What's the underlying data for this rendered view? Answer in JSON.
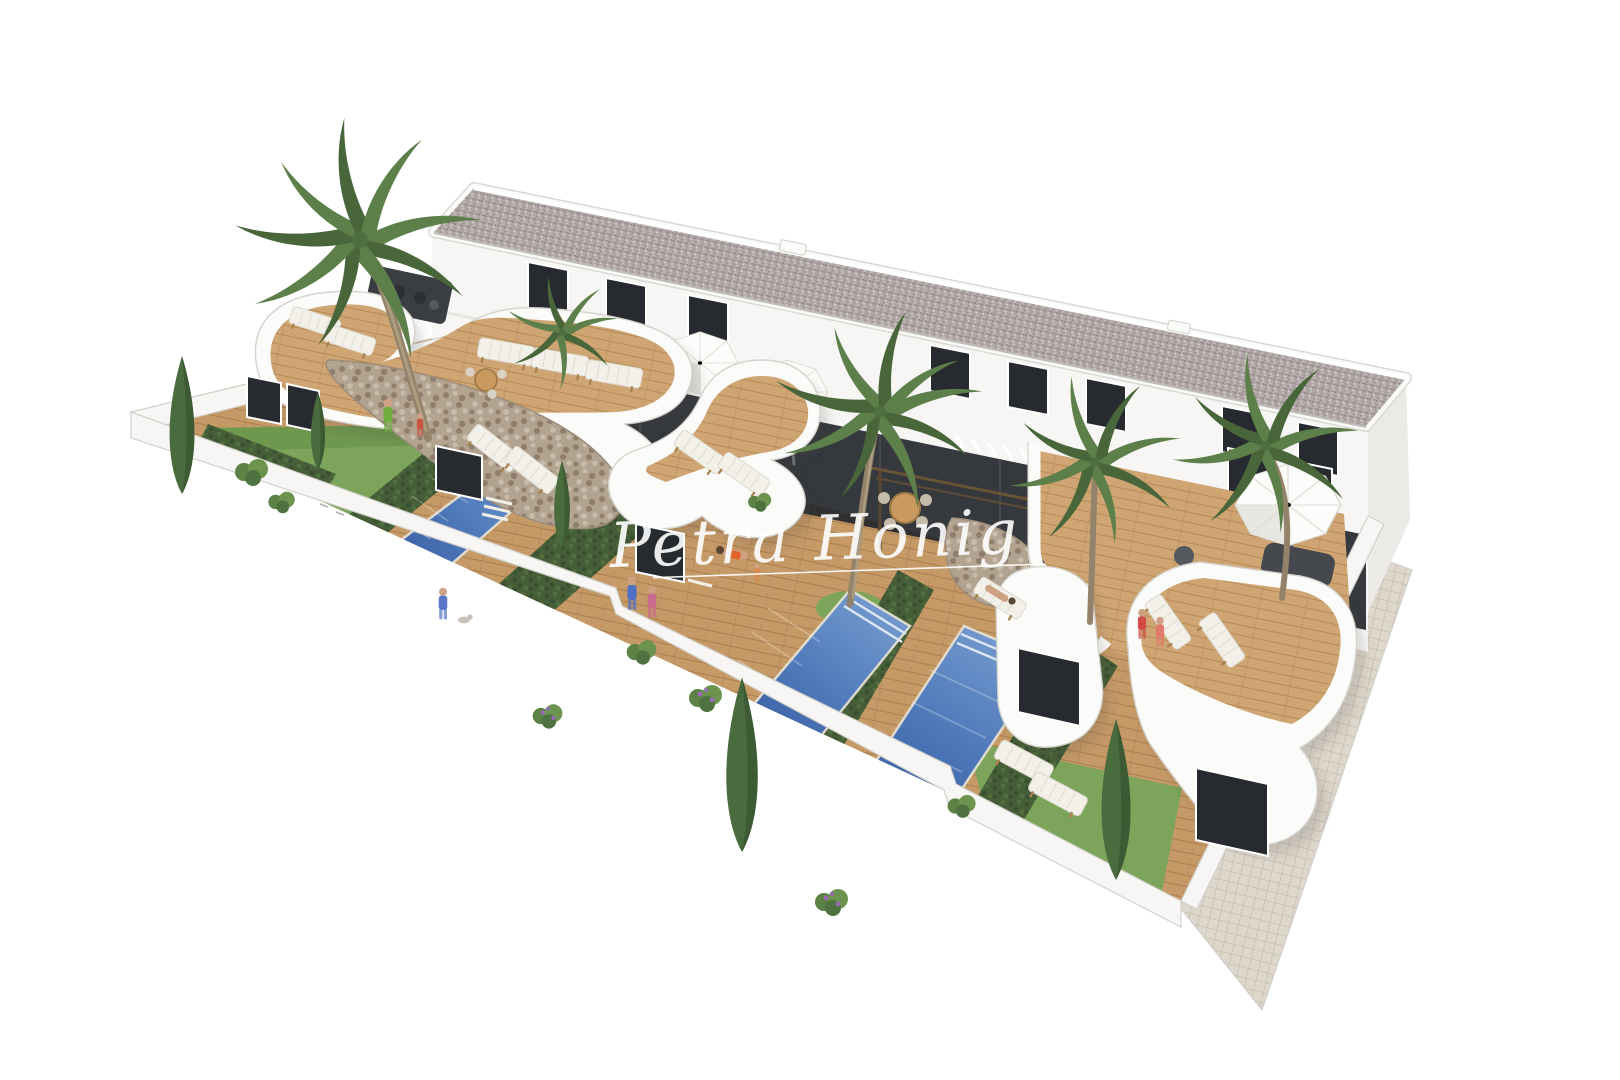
{
  "meta": {
    "title": "Aerial 3D architectural render — terraced houses with private pools",
    "type": "architectural-render",
    "view": "high-angle aerial"
  },
  "watermark": {
    "text": "Petra Honig",
    "underline": true,
    "color": "rgba(255,255,255,0.9)"
  },
  "scene": {
    "background": "#ffffff",
    "building": {
      "floors": 2,
      "facade": "white render",
      "roof": "flat gray gravel roof with white parapet",
      "upper_window_count": 8,
      "ground_glass_door_count": 7
    },
    "units_visible": 4,
    "pool_count": 3,
    "palm_count": 5,
    "cypress_count": 5,
    "umbrella_count": 3,
    "lounger_count": 14,
    "dining_sets": 2,
    "people_count": 10,
    "dog_count": 1,
    "features": [
      "curved white roof terraces",
      "wooden decks",
      "private rectangular pools",
      "dividing hedges",
      "stone-clad feature walls",
      "white perimeter wall",
      "tiled side walkway",
      "lawn areas with shrubs"
    ]
  },
  "palette": {
    "background": "#ffffff",
    "building_white": "#f7f6f4",
    "building_shade": "#ebeae7",
    "edge_gray": "#d2d1cb",
    "roof_gravel": "#b0a7a6",
    "roof_dot_dark": "#857c7c",
    "roof_dot_light": "#d6d0d0",
    "window_dark": "#272a2e",
    "glass_dark": "#24272b",
    "deck_wood": "#c69a67",
    "deck_wood_line": "#aa7f4e",
    "terrace_wood": "#cfa573",
    "terrace_wood_line": "#b68a55",
    "pool_light": "#7298cd",
    "pool_mid": "#4c77b8",
    "pool_dark": "#37589f",
    "grass": "#7ca45a",
    "grass_dark": "#618c43",
    "hedge": "#475f39",
    "hedge_dark": "#39512e",
    "palm": "#5d7f4a",
    "palm_dark": "#48663a",
    "trunk": "#93836a",
    "stone": "#b2a290",
    "stone_dark": "#8f7e6c",
    "stone_light": "#cabcab",
    "tile": "#ded7cb",
    "tile_line": "#bab3a7",
    "umbrella": "#fcfcfa",
    "lounger": "#f3f0e9",
    "furniture_dark": "#45484d",
    "pouf": "#54575b",
    "wood_frame": "#a8834f",
    "purple_bloom": "#9a68b8",
    "skin": "#cfa184",
    "watermark": "rgba(255,255,255,0.9)"
  }
}
